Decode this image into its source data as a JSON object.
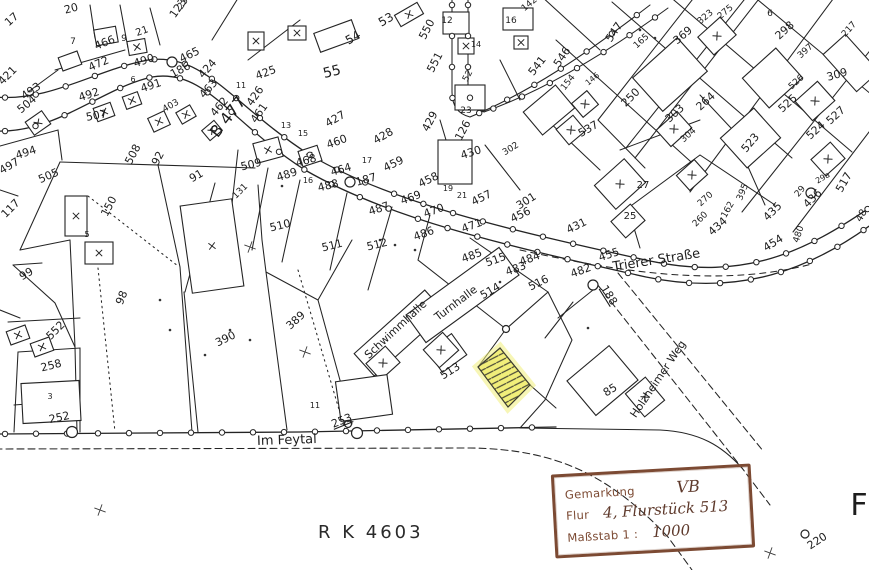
{
  "title": "Kataster-Flurkarte",
  "highlight": {
    "parcel": "513",
    "fill": "#f1ee7a",
    "hatch_color": "#4a4a38"
  },
  "footer": {
    "plan_number": "R K 4603"
  },
  "stamp": {
    "field1_label": "Gemarkung",
    "field1_value": "VB",
    "field2_label": "Flur",
    "field2_value": "4, Flurstück 513",
    "field3_label": "Maßstab 1 :",
    "field3_value": "1000",
    "border_color": "#7c4a33"
  },
  "map": {
    "street_names": [
      "B 477",
      "Trierer Straße",
      "Im Feytal",
      "Holzheimer Weg"
    ],
    "building_names": [
      "Schwimmhalle",
      "Turnhalle"
    ],
    "labels": [
      {
        "t": "B 477",
        "x": 232,
        "y": 120,
        "r": -52,
        "s": 16,
        "k": "street-label"
      },
      {
        "t": "Trierer Straße",
        "x": 657,
        "y": 264,
        "r": -9,
        "s": 13,
        "k": "street-label"
      },
      {
        "t": "Im Feytal",
        "x": 287,
        "y": 444,
        "r": -2,
        "s": 13,
        "k": "street-label"
      },
      {
        "t": "Holzheimer Weg",
        "x": 661,
        "y": 381,
        "r": -56,
        "s": 11,
        "k": "street-label"
      },
      {
        "t": "Schwimmhalle",
        "x": 398,
        "y": 332,
        "r": -43,
        "s": 11,
        "k": "building-label"
      },
      {
        "t": "Turnhalle",
        "x": 458,
        "y": 306,
        "r": -37,
        "s": 11,
        "k": "building-label"
      },
      {
        "t": "20",
        "x": 72,
        "y": 12,
        "r": -15
      },
      {
        "t": "17",
        "x": 14,
        "y": 22,
        "r": -42
      },
      {
        "t": "123",
        "x": 181,
        "y": 10,
        "r": -55
      },
      {
        "t": "7",
        "x": 73,
        "y": 44,
        "s": 9
      },
      {
        "t": "9",
        "x": 124,
        "y": 41,
        "s": 9
      },
      {
        "t": "21",
        "x": 143,
        "y": 34,
        "r": -20,
        "s": 10
      },
      {
        "t": "466",
        "x": 106,
        "y": 46,
        "r": -22
      },
      {
        "t": "472",
        "x": 100,
        "y": 67,
        "r": -24
      },
      {
        "t": "490",
        "x": 145,
        "y": 64,
        "r": -18
      },
      {
        "t": "186",
        "x": 182,
        "y": 73,
        "r": -28
      },
      {
        "t": "465",
        "x": 191,
        "y": 58,
        "r": -26
      },
      {
        "t": "424",
        "x": 210,
        "y": 71,
        "r": -48
      },
      {
        "t": "463",
        "x": 211,
        "y": 91,
        "r": -48
      },
      {
        "t": "462",
        "x": 222,
        "y": 109,
        "r": -50
      },
      {
        "t": "421",
        "x": 10,
        "y": 78,
        "r": -45
      },
      {
        "t": "493",
        "x": 33,
        "y": 94,
        "r": -35
      },
      {
        "t": "504",
        "x": 29,
        "y": 107,
        "r": -40
      },
      {
        "t": "492",
        "x": 90,
        "y": 98,
        "r": -18
      },
      {
        "t": "491",
        "x": 152,
        "y": 89,
        "r": -18
      },
      {
        "t": "6",
        "x": 133,
        "y": 82,
        "s": 8
      },
      {
        "t": "23",
        "x": 185,
        "y": 5,
        "r": -55,
        "s": 9
      },
      {
        "t": "507",
        "x": 97,
        "y": 119,
        "r": -10
      },
      {
        "t": "508",
        "x": 136,
        "y": 156,
        "r": -62
      },
      {
        "t": "92",
        "x": 161,
        "y": 160,
        "r": -62
      },
      {
        "t": "91",
        "x": 198,
        "y": 179,
        "r": -30
      },
      {
        "t": "505",
        "x": 50,
        "y": 179,
        "r": -24
      },
      {
        "t": "494",
        "x": 27,
        "y": 156,
        "r": -18
      },
      {
        "t": "497",
        "x": 11,
        "y": 169,
        "r": -30
      },
      {
        "t": "403",
        "x": 172,
        "y": 108,
        "r": -30,
        "s": 9
      },
      {
        "t": "99",
        "x": 28,
        "y": 277,
        "r": -30
      },
      {
        "t": "117",
        "x": 13,
        "y": 211,
        "r": -45
      },
      {
        "t": "150",
        "x": 112,
        "y": 208,
        "r": -62
      },
      {
        "t": "5",
        "x": 87,
        "y": 237,
        "s": 8
      },
      {
        "t": "131",
        "x": 242,
        "y": 193,
        "r": -45,
        "s": 9
      },
      {
        "t": "509",
        "x": 252,
        "y": 168,
        "r": -14
      },
      {
        "t": "489",
        "x": 288,
        "y": 178,
        "r": -18
      },
      {
        "t": "488",
        "x": 329,
        "y": 189,
        "r": -14
      },
      {
        "t": "460",
        "x": 338,
        "y": 145,
        "r": -20
      },
      {
        "t": "468",
        "x": 307,
        "y": 164,
        "r": -16
      },
      {
        "t": "464",
        "x": 342,
        "y": 173,
        "r": -16
      },
      {
        "t": "187",
        "x": 367,
        "y": 183,
        "r": -16
      },
      {
        "t": "487",
        "x": 380,
        "y": 212,
        "r": -18
      },
      {
        "t": "486",
        "x": 425,
        "y": 237,
        "r": -20
      },
      {
        "t": "510",
        "x": 281,
        "y": 229,
        "r": -14
      },
      {
        "t": "511",
        "x": 333,
        "y": 249,
        "r": -14
      },
      {
        "t": "512",
        "x": 378,
        "y": 248,
        "r": -14
      },
      {
        "t": "469",
        "x": 412,
        "y": 201,
        "r": -20
      },
      {
        "t": "470",
        "x": 435,
        "y": 214,
        "r": -20
      },
      {
        "t": "471",
        "x": 473,
        "y": 229,
        "r": -20
      },
      {
        "t": "459",
        "x": 395,
        "y": 167,
        "r": -26
      },
      {
        "t": "458",
        "x": 430,
        "y": 183,
        "r": -26
      },
      {
        "t": "457",
        "x": 483,
        "y": 201,
        "r": -26
      },
      {
        "t": "456",
        "x": 522,
        "y": 218,
        "r": -26
      },
      {
        "t": "428",
        "x": 385,
        "y": 139,
        "r": -30
      },
      {
        "t": "429",
        "x": 433,
        "y": 123,
        "r": -62
      },
      {
        "t": "126",
        "x": 466,
        "y": 132,
        "r": -62
      },
      {
        "t": "430",
        "x": 472,
        "y": 156,
        "r": -18
      },
      {
        "t": "431",
        "x": 578,
        "y": 229,
        "r": -26
      },
      {
        "t": "301",
        "x": 528,
        "y": 204,
        "r": -32
      },
      {
        "t": "302",
        "x": 512,
        "y": 151,
        "r": -32,
        "s": 9
      },
      {
        "t": "537",
        "x": 590,
        "y": 132,
        "r": -30
      },
      {
        "t": "25",
        "x": 630,
        "y": 219,
        "s": 10
      },
      {
        "t": "27",
        "x": 643,
        "y": 188,
        "s": 10
      },
      {
        "t": "304",
        "x": 690,
        "y": 137,
        "r": -42,
        "s": 9
      },
      {
        "t": "523",
        "x": 753,
        "y": 145,
        "r": -50
      },
      {
        "t": "270",
        "x": 707,
        "y": 201,
        "r": -42,
        "s": 9
      },
      {
        "t": "162",
        "x": 730,
        "y": 211,
        "r": -60,
        "s": 9
      },
      {
        "t": "260",
        "x": 702,
        "y": 221,
        "r": -45,
        "s": 9
      },
      {
        "t": "434",
        "x": 720,
        "y": 229,
        "r": -42
      },
      {
        "t": "395",
        "x": 745,
        "y": 193,
        "r": -68,
        "s": 9
      },
      {
        "t": "435",
        "x": 775,
        "y": 214,
        "r": -45
      },
      {
        "t": "436",
        "x": 815,
        "y": 201,
        "r": -45
      },
      {
        "t": "29",
        "x": 802,
        "y": 193,
        "r": -50,
        "s": 9
      },
      {
        "t": "29a",
        "x": 824,
        "y": 180,
        "r": -30,
        "s": 8
      },
      {
        "t": "517",
        "x": 847,
        "y": 184,
        "r": -60
      },
      {
        "t": "454",
        "x": 775,
        "y": 246,
        "r": -32
      },
      {
        "t": "480",
        "x": 801,
        "y": 235,
        "r": -72,
        "s": 9
      },
      {
        "t": "48",
        "x": 864,
        "y": 217,
        "r": -60,
        "s": 10
      },
      {
        "t": "455",
        "x": 610,
        "y": 258,
        "r": -18
      },
      {
        "t": "482",
        "x": 582,
        "y": 274,
        "r": -20
      },
      {
        "t": "188",
        "x": 606,
        "y": 297,
        "r": 58,
        "u": 1
      },
      {
        "t": "485",
        "x": 473,
        "y": 259,
        "r": -20
      },
      {
        "t": "515",
        "x": 497,
        "y": 263,
        "r": -20
      },
      {
        "t": "483",
        "x": 517,
        "y": 272,
        "r": -20
      },
      {
        "t": "484",
        "x": 531,
        "y": 262,
        "r": -20
      },
      {
        "t": "516",
        "x": 540,
        "y": 286,
        "r": -26
      },
      {
        "t": "514",
        "x": 492,
        "y": 294,
        "r": -30
      },
      {
        "t": "513",
        "x": 452,
        "y": 374,
        "r": -32
      },
      {
        "t": "389",
        "x": 298,
        "y": 323,
        "r": -42
      },
      {
        "t": "390",
        "x": 227,
        "y": 342,
        "r": -26
      },
      {
        "t": "98",
        "x": 125,
        "y": 299,
        "r": -68
      },
      {
        "t": "552",
        "x": 58,
        "y": 333,
        "r": -45
      },
      {
        "t": "258",
        "x": 52,
        "y": 369,
        "r": -14
      },
      {
        "t": "3",
        "x": 50,
        "y": 399,
        "s": 8
      },
      {
        "t": "252",
        "x": 60,
        "y": 421,
        "r": -12
      },
      {
        "t": "253",
        "x": 343,
        "y": 424,
        "r": -22,
        "u": 1
      },
      {
        "t": "85",
        "x": 612,
        "y": 393,
        "r": -32
      },
      {
        "t": "11",
        "x": 315,
        "y": 408,
        "s": 8
      },
      {
        "t": "165",
        "x": 643,
        "y": 43,
        "r": -42,
        "s": 9
      },
      {
        "t": "369",
        "x": 685,
        "y": 38,
        "r": -40
      },
      {
        "t": "323",
        "x": 707,
        "y": 19,
        "r": -40,
        "s": 9
      },
      {
        "t": "275",
        "x": 727,
        "y": 14,
        "r": -40,
        "s": 9
      },
      {
        "t": "6",
        "x": 770,
        "y": 16,
        "s": 9
      },
      {
        "t": "298",
        "x": 787,
        "y": 33,
        "r": -42
      },
      {
        "t": "397",
        "x": 807,
        "y": 53,
        "r": -42,
        "s": 9
      },
      {
        "t": "309",
        "x": 838,
        "y": 78,
        "r": -16
      },
      {
        "t": "264",
        "x": 708,
        "y": 104,
        "r": -42
      },
      {
        "t": "303",
        "x": 677,
        "y": 116,
        "r": -42
      },
      {
        "t": "250",
        "x": 633,
        "y": 100,
        "r": -45
      },
      {
        "t": "525",
        "x": 790,
        "y": 106,
        "r": -42
      },
      {
        "t": "526",
        "x": 798,
        "y": 84,
        "r": -42,
        "s": 9
      },
      {
        "t": "527",
        "x": 838,
        "y": 118,
        "r": -42
      },
      {
        "t": "524",
        "x": 818,
        "y": 133,
        "r": -42
      },
      {
        "t": "217",
        "x": 851,
        "y": 31,
        "r": -48,
        "s": 9
      },
      {
        "t": "550",
        "x": 430,
        "y": 31,
        "r": -62
      },
      {
        "t": "12",
        "x": 447,
        "y": 23,
        "s": 9
      },
      {
        "t": "16",
        "x": 511,
        "y": 23,
        "s": 9
      },
      {
        "t": "142",
        "x": 531,
        "y": 6,
        "r": -40,
        "s": 9
      },
      {
        "t": "551",
        "x": 438,
        "y": 64,
        "r": -62
      },
      {
        "t": "52",
        "x": 470,
        "y": 77,
        "r": -62,
        "s": 9
      },
      {
        "t": "14",
        "x": 476,
        "y": 47,
        "s": 8
      },
      {
        "t": "541",
        "x": 540,
        "y": 68,
        "r": -52
      },
      {
        "t": "546",
        "x": 565,
        "y": 59,
        "r": -56
      },
      {
        "t": "547",
        "x": 617,
        "y": 34,
        "r": -56
      },
      {
        "t": "154",
        "x": 570,
        "y": 84,
        "r": -52,
        "s": 9
      },
      {
        "t": "146",
        "x": 594,
        "y": 81,
        "r": -40,
        "s": 8
      },
      {
        "t": "23",
        "x": 466,
        "y": 113,
        "s": 9
      },
      {
        "t": "53",
        "x": 388,
        "y": 23,
        "r": -30,
        "s": 12
      },
      {
        "t": "54",
        "x": 355,
        "y": 41,
        "r": -30,
        "s": 12
      },
      {
        "t": "55",
        "x": 333,
        "y": 76,
        "r": -14,
        "s": 14
      },
      {
        "t": "425",
        "x": 267,
        "y": 76,
        "r": -20
      },
      {
        "t": "426",
        "x": 258,
        "y": 98,
        "r": -55
      },
      {
        "t": "461",
        "x": 262,
        "y": 115,
        "r": -55
      },
      {
        "t": "427",
        "x": 337,
        "y": 122,
        "r": -30
      },
      {
        "t": "13",
        "x": 286,
        "y": 128,
        "s": 8
      },
      {
        "t": "15",
        "x": 303,
        "y": 136,
        "s": 8
      },
      {
        "t": "11",
        "x": 241,
        "y": 88,
        "s": 8
      },
      {
        "t": "17",
        "x": 367,
        "y": 163,
        "s": 8
      },
      {
        "t": "19",
        "x": 448,
        "y": 191,
        "s": 8
      },
      {
        "t": "21",
        "x": 462,
        "y": 198,
        "s": 8
      },
      {
        "t": "16",
        "x": 308,
        "y": 183,
        "s": 8
      },
      {
        "t": "220",
        "x": 819,
        "y": 544,
        "r": -33,
        "s": 11,
        "k": "point-label"
      },
      {
        "t": "F",
        "x": 859,
        "y": 515,
        "s": 30,
        "k": "edge-letter"
      }
    ]
  }
}
